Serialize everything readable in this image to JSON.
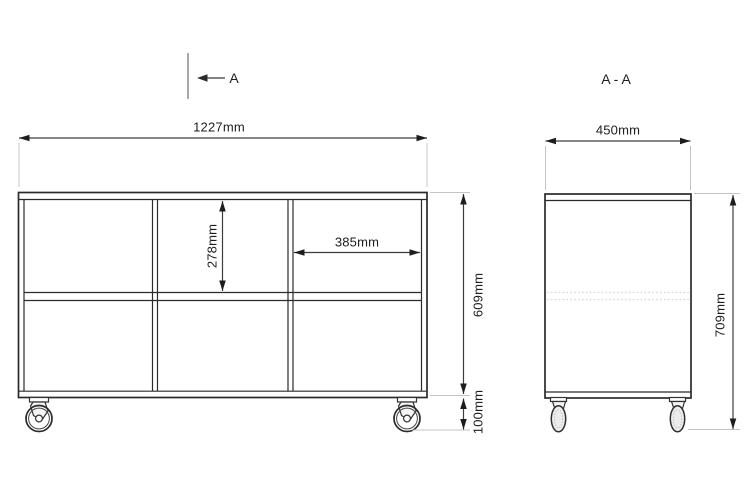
{
  "drawing_title": "A - A",
  "section_marker": {
    "label": "A"
  },
  "front_view": {
    "overall_width": "1227mm",
    "compartment_width": "385mm",
    "compartment_height": "278mm",
    "body_height": "609mm",
    "caster_height": "100mm"
  },
  "section_view": {
    "depth": "450mm",
    "overall_height": "709mm"
  },
  "colors": {
    "background": "#ffffff",
    "line": "#2b2b2b",
    "dimension": "#3c3c3c",
    "extension": "#c4c4c4",
    "hidden_line": "#d4d4d4",
    "section_line": "#8a8a8a"
  }
}
